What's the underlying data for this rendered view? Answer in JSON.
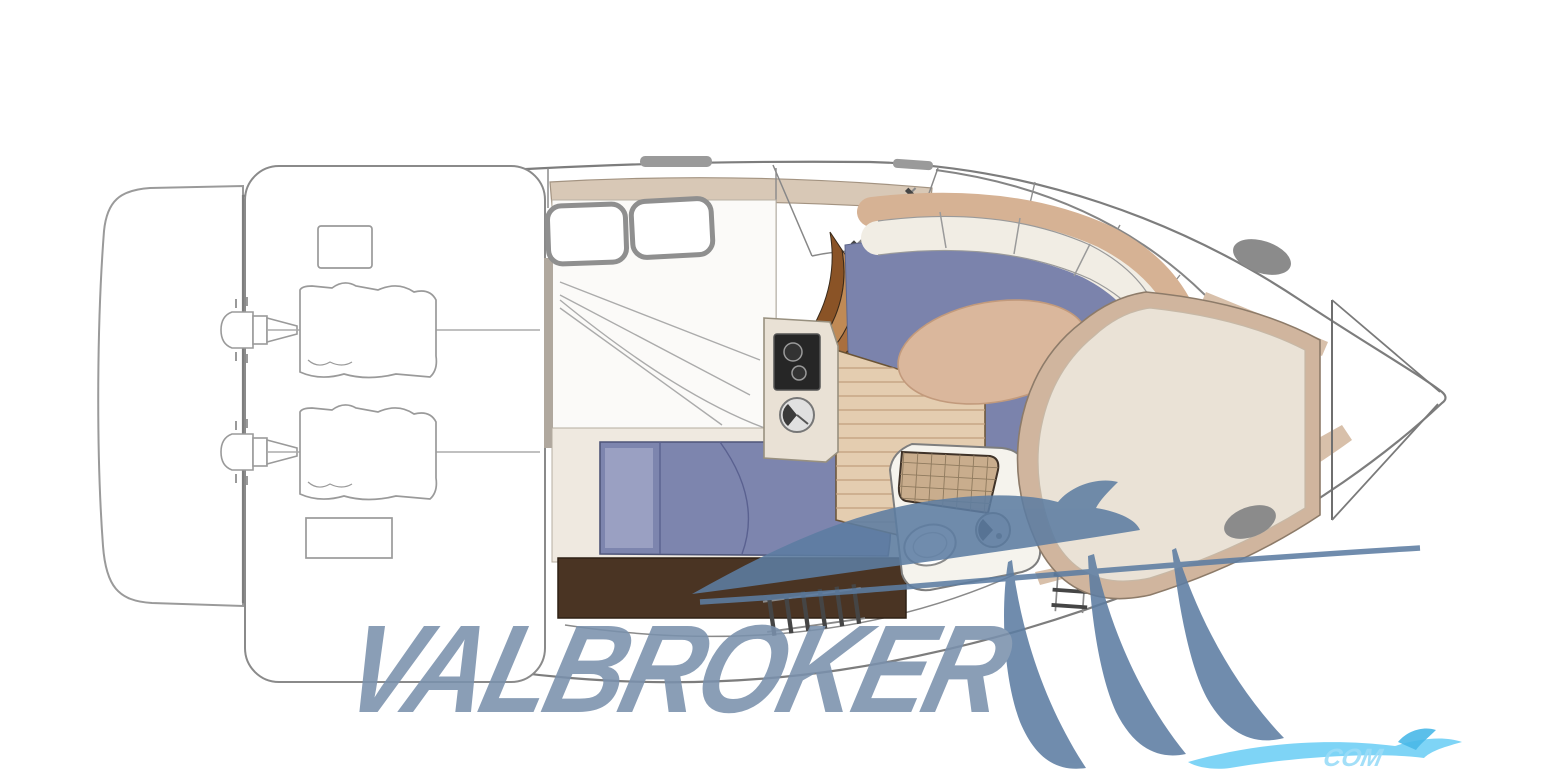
{
  "image": {
    "type": "boat-floor-plan-diagram",
    "description": "Top-view interior layout plan of a motor yacht with twin sterndrive engines, aft cabin, galley, head, curved salon settee with oval table and bow V-berth",
    "background": "#ffffff"
  },
  "watermark": {
    "brand": "VALBROKER",
    "corner_text": "COM"
  },
  "parts": [
    "swim-platform",
    "engine-room",
    "port-engine",
    "starboard-engine",
    "storage-locker-top",
    "storage-locker-bottom",
    "mid-cabin-berth",
    "mid-cabin-pillows",
    "companionway-ladder",
    "companionway-steps",
    "cockpit-boarding-ladder",
    "galley-stove",
    "galley-sink",
    "teak-floor",
    "salon-floor",
    "curved-settee",
    "oval-table",
    "head-compartment",
    "shower-grate",
    "toilet",
    "wash-basin",
    "side-ladder",
    "v-berth",
    "deck-hatch-fore",
    "deck-hatch-mid",
    "windshield",
    "bow-anchor-locker"
  ],
  "colors": {
    "hull-stroke": "#7d7d7d",
    "sketch-stroke": "#9a9a9a",
    "tan-deck": "#d8c8b6",
    "walkway-tan": "#d8c0aa",
    "salon-floor": "#7b83ac",
    "table-tan": "#dab79c",
    "sofa-back": "#d6b294",
    "cushion": "#f1ede4",
    "vberth-rim": "#d0b59e",
    "vberth-bed": "#eae2d6",
    "wood": "#e4cdb0",
    "wood-line": "#c19f7d",
    "steps-dark": "#8a5326",
    "steps-mid": "#a96f3f",
    "steps-light": "#c08a55",
    "bed-purple": "#7d85ae",
    "bed-pillow": "#9aa0c2",
    "bed-base": "#efe9e0",
    "floor-brown": "#4a3423",
    "stove-black": "#262626",
    "hatch-gray": "#8b8b8b",
    "wm": "#7a91ad",
    "wm2": "#5d7da2",
    "corner-blue": "#67cdf4",
    "corner-text-blue": "#9adcf8"
  }
}
